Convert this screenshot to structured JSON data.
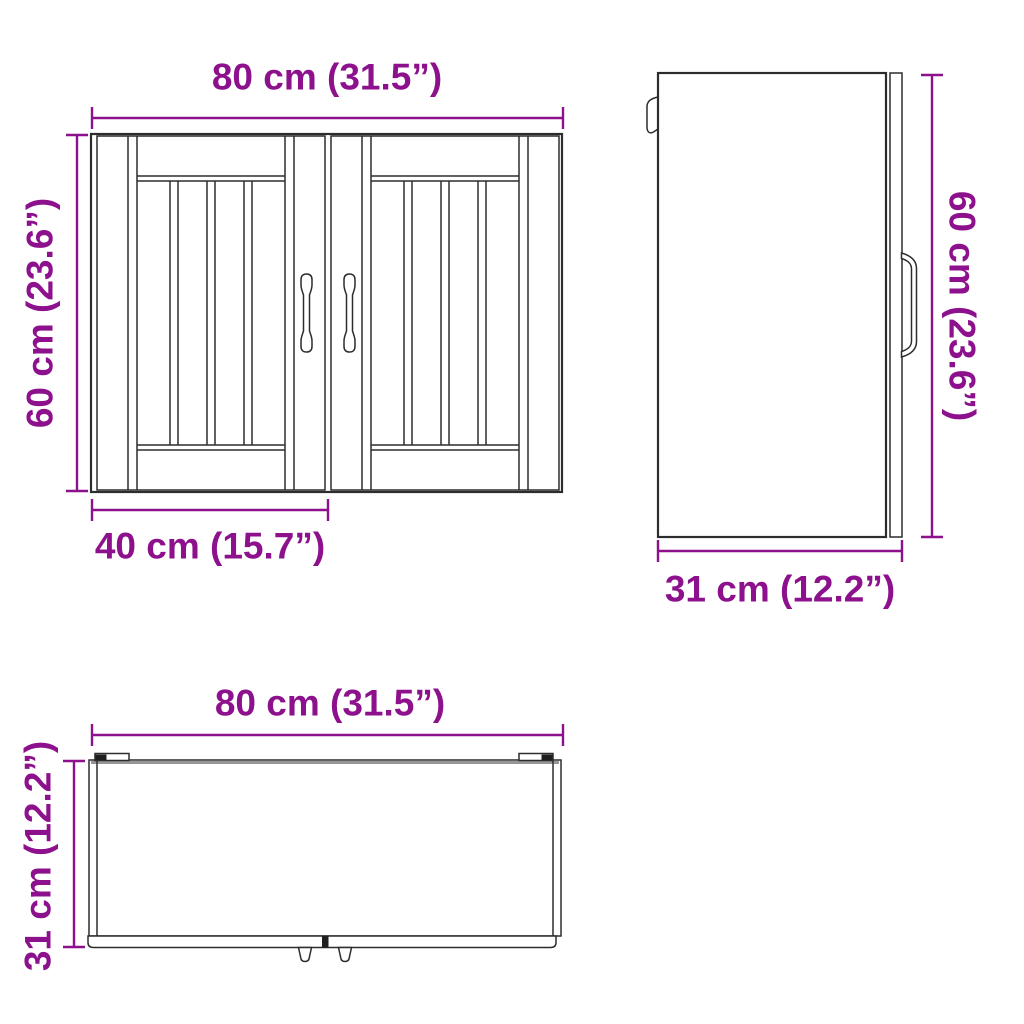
{
  "colors": {
    "accent": "#8d118d",
    "line": "#2d2d2d",
    "background": "#ffffff"
  },
  "views": {
    "front": {
      "width_label": "80 cm (31.5”)",
      "height_label": "60 cm (23.6”)",
      "door_width_label": "40 cm (15.7”)"
    },
    "side": {
      "height_label": "60 cm (23.6”)",
      "depth_label": "31 cm (12.2”)"
    },
    "top": {
      "width_label": "80 cm (31.5”)",
      "depth_label": "31 cm (12.2”)"
    }
  }
}
